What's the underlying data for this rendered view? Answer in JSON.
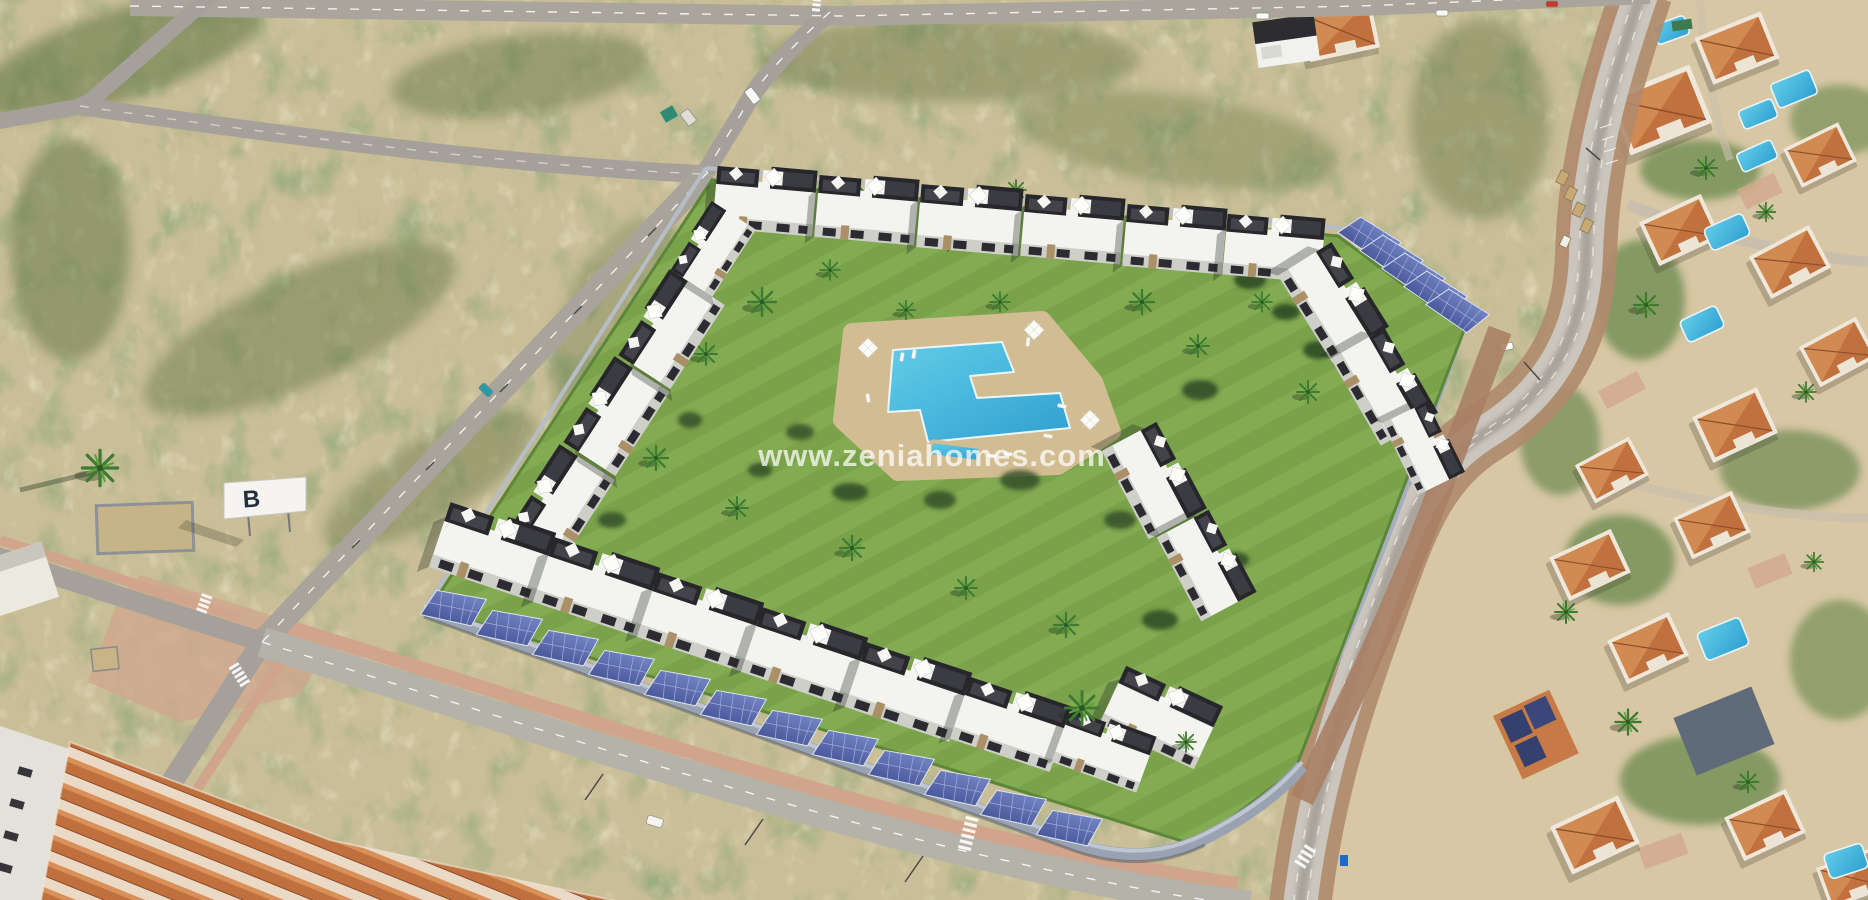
{
  "scene": {
    "type": "aerial-real-estate-render",
    "description": "Aerial drone view of a new-build residential complex with communal pool, lawns, palm trees and solar carports, surrounded by vacant scrubland (left), an existing villa neighbourhood (right) and terracotta townhouses (bottom-left)",
    "watermark": {
      "text": "www.zeniahomes.com",
      "color": "#ffffff"
    },
    "billboard": {
      "letter": "B"
    },
    "palette": {
      "scrub_base": "#c9be97",
      "scrub_green": "#4d6634",
      "road_asphalt": "#a5a19a",
      "road_light": "#cac6bd",
      "sidewalk_pink": "#d0a58c",
      "dirt_strip": "#b08a6d",
      "lawn": "#79a24a",
      "lawn_light": "#82ab52",
      "pool_water": "#49b9dc",
      "pool_deck": "#d2bd92",
      "building_white": "#f3f3f0",
      "building_charcoal": "#26262b",
      "stone_accent": "#ab9067",
      "solar_panel": "#5e6ca8",
      "terracotta": "#c0703d",
      "terracotta_dark": "#a05630",
      "villa_ground": "#d7c7a5",
      "perimeter_wall": "#98a2b0",
      "car_teal": "#2a9aa8",
      "car_red": "#c43a2c"
    },
    "regions": [
      {
        "name": "vacant-scrubland",
        "position": "top-left"
      },
      {
        "name": "new-build-residential-complex",
        "position": "center"
      },
      {
        "name": "communal-pool-and-garden",
        "position": "center"
      },
      {
        "name": "solar-carport-rows",
        "position": "south-and-east-perimeter"
      },
      {
        "name": "existing-villa-neighbourhood",
        "position": "right"
      },
      {
        "name": "terracotta-townhouses",
        "position": "bottom-left"
      },
      {
        "name": "road-network",
        "position": "around-complex"
      }
    ]
  }
}
